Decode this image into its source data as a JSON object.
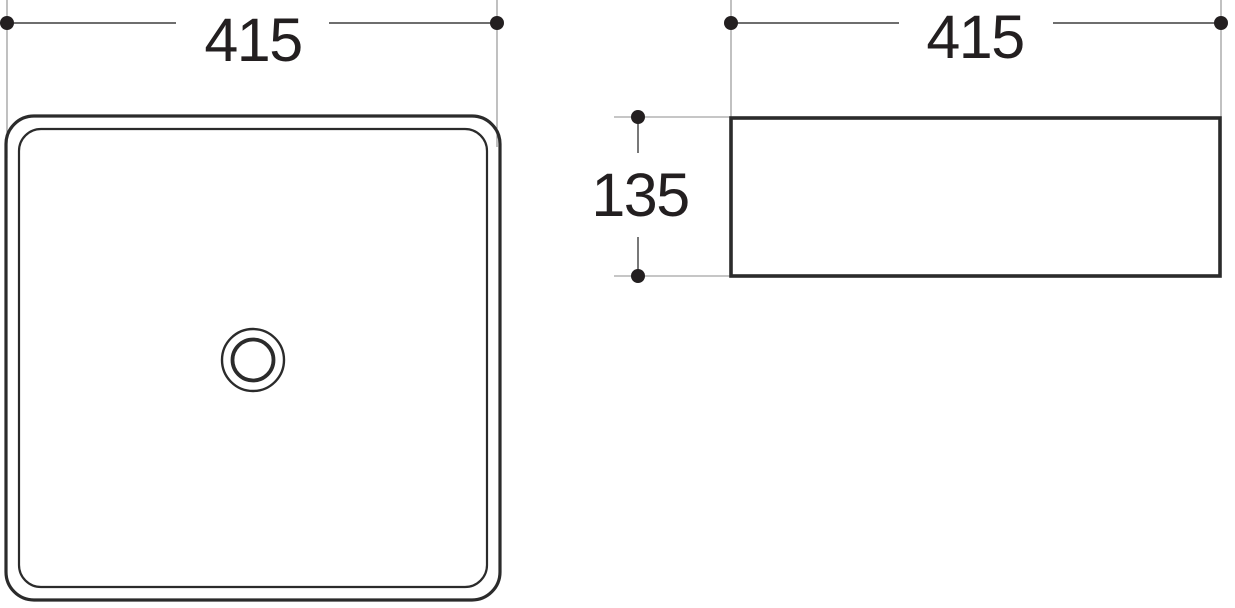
{
  "dimensions": {
    "top_view_width": "415",
    "side_view_width": "415",
    "side_view_height": "135"
  },
  "colors": {
    "background": "#ffffff",
    "outline": "#2b2b2b",
    "dimension_line": "#3f3f3f",
    "extension_line": "#8e8e8e",
    "dot": "#231f20",
    "text": "#231f20"
  }
}
